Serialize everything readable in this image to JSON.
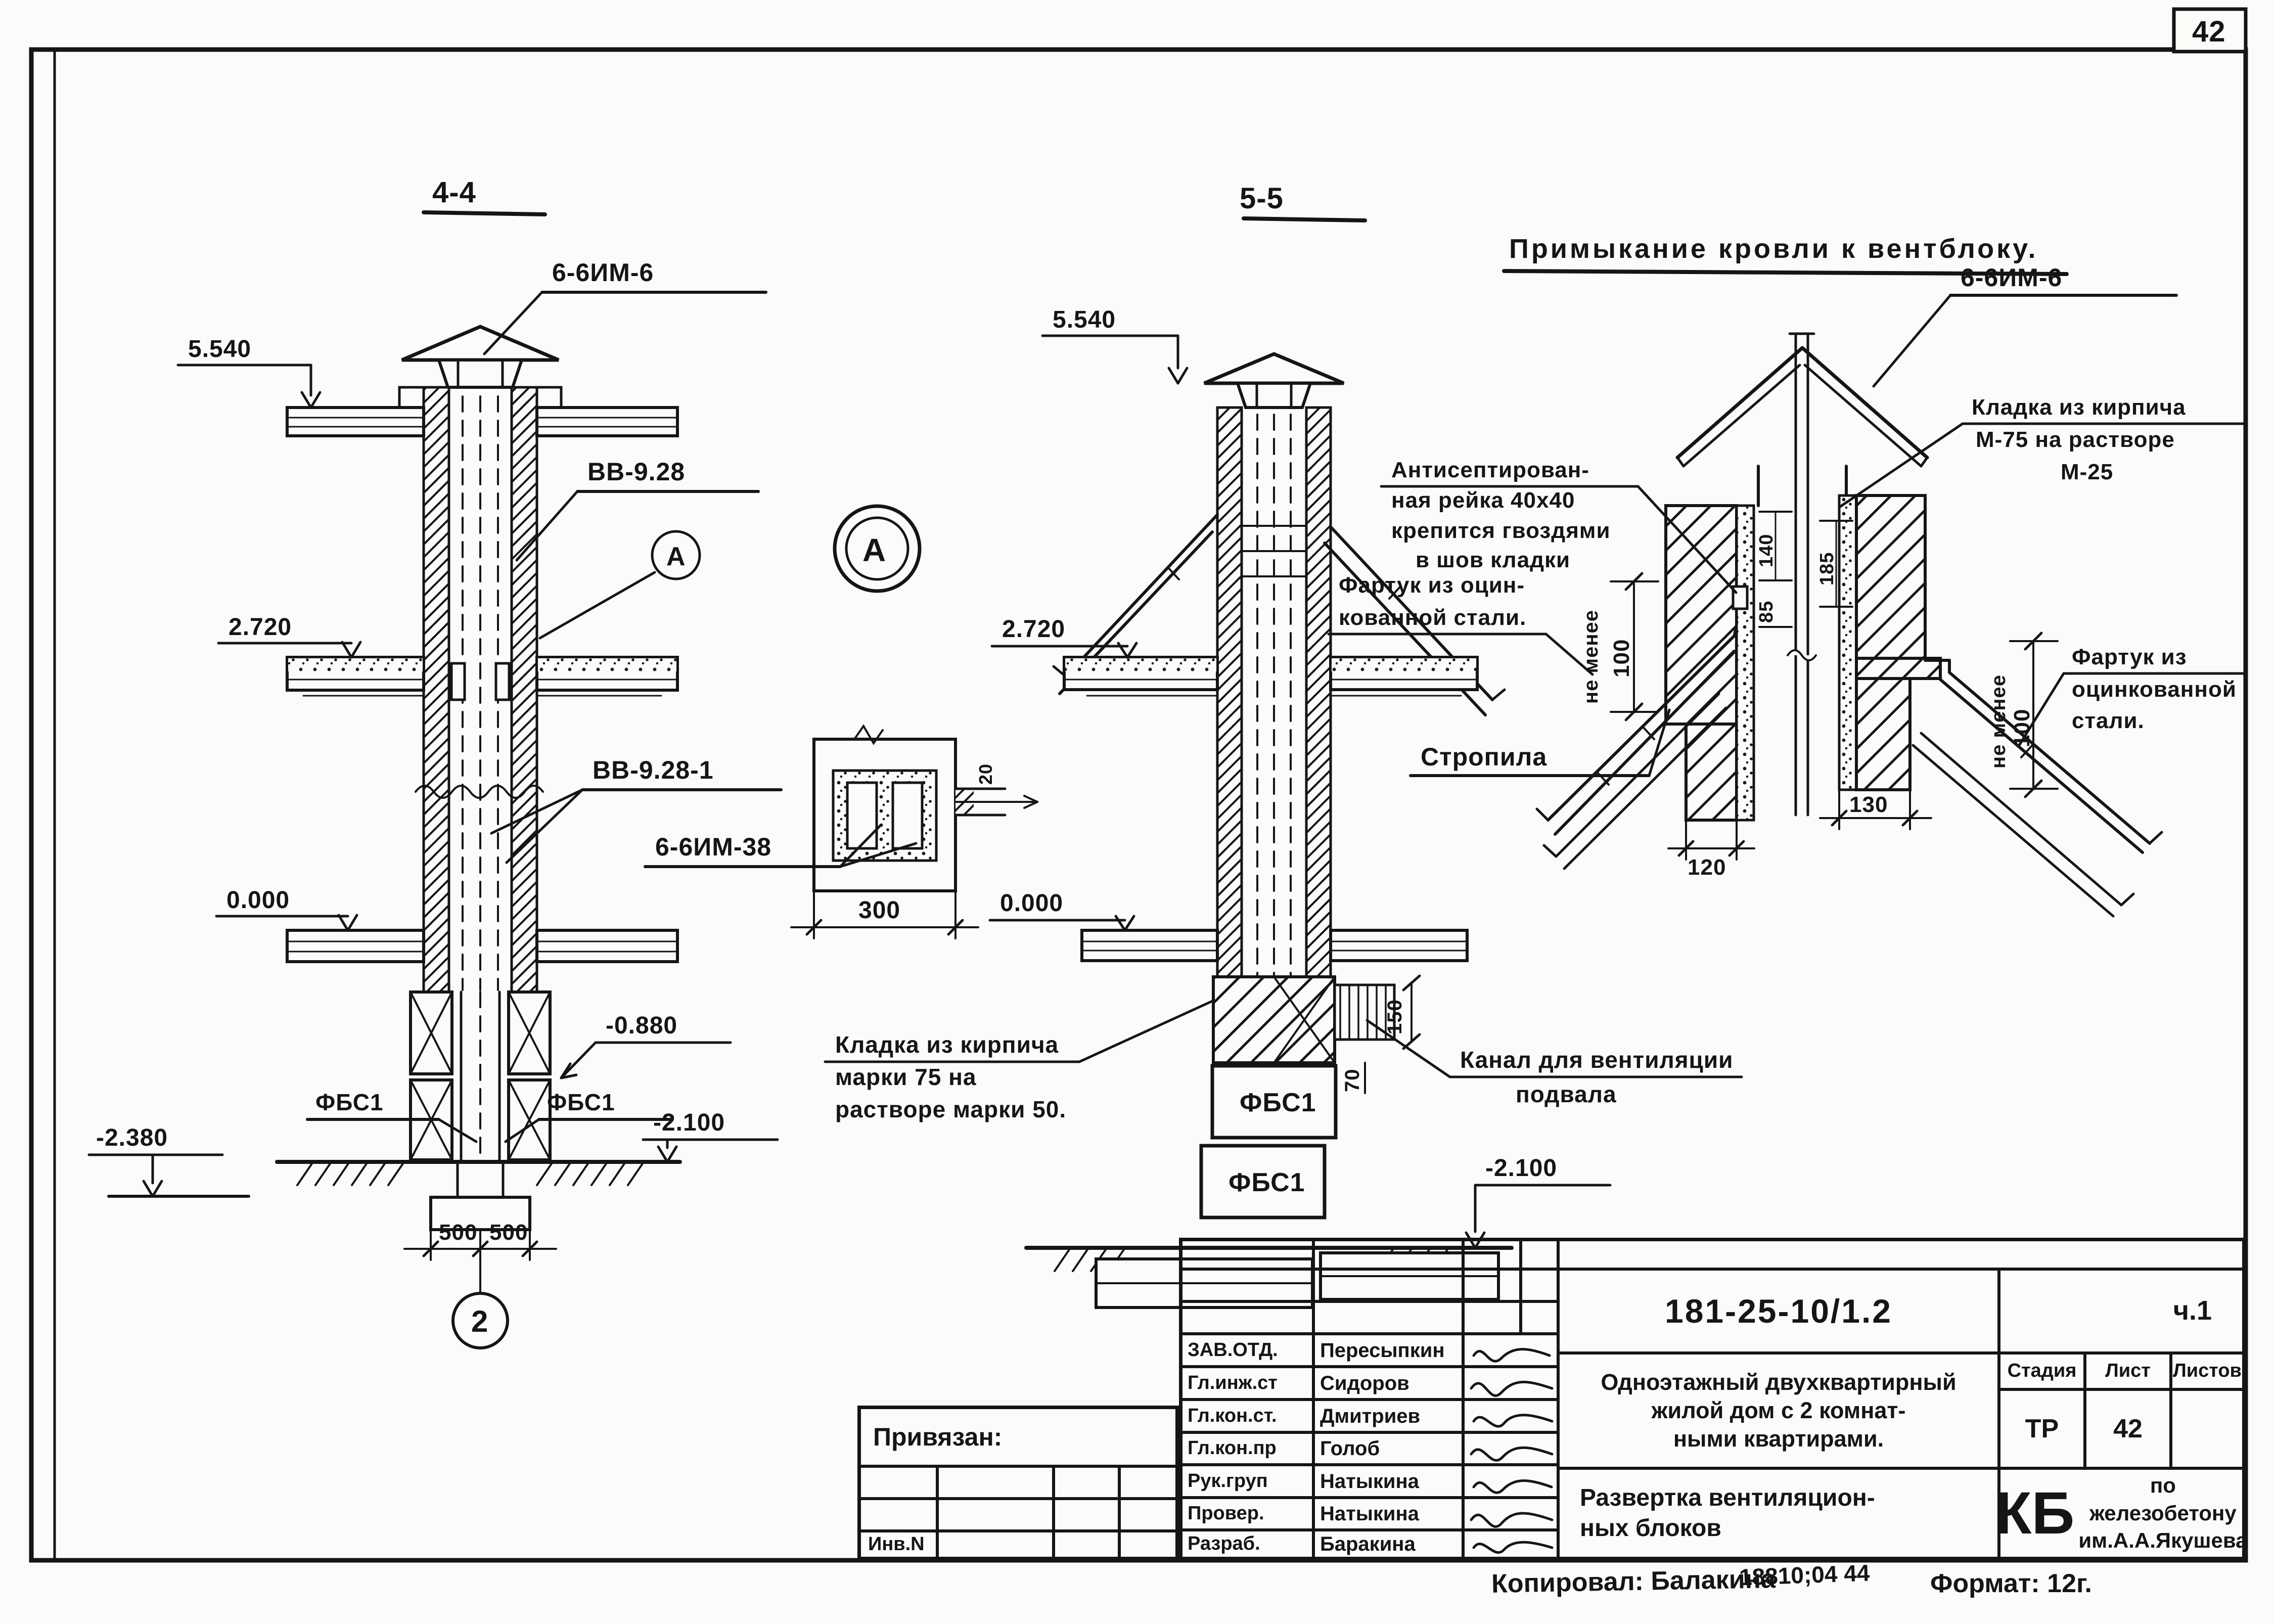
{
  "sheet": {
    "corner_number": "42",
    "copied_by": "Копировал: Балакина",
    "order_note": "18810;04 44",
    "format_note": "Формат: 12г."
  },
  "s44": {
    "title": "4-4",
    "cap_label": "6-6ИМ-6",
    "panel_label": "ВВ-9.28",
    "panel_label2": "ВВ-9.28-1",
    "view_marker": "А",
    "elev_top": "5.540",
    "elev_floor": "2.720",
    "elev_zero": "0.000",
    "elev_base": "-0.880",
    "elev_left": "-2.380",
    "elev_right": "-2.100",
    "fbs_left": "ФБС1",
    "fbs_right": "ФБС1",
    "dim_500_left": "500",
    "dim_500_right": "500",
    "axis_no": "2"
  },
  "detail_a": {
    "marker": "А",
    "label": "6-6ИМ-38",
    "dim_width": "300",
    "dim_duct": "20"
  },
  "s55": {
    "title": "5-5",
    "elev_top": "5.540",
    "elev_floor": "2.720",
    "elev_zero": "0.000",
    "elev_ground": "-2.100",
    "fbs_top": "ФБС1",
    "fbs_bottom": "ФБС1",
    "dim_150": "150",
    "dim_70": "70",
    "note_brick": [
      "Кладка из кирпича",
      "марки 75 на",
      "растворе марки 50."
    ],
    "note_canal": [
      "Канал для вентиляции",
      "подвала"
    ]
  },
  "roof_detail": {
    "title": "Примыкание кровли к вентблоку.",
    "cap_label": "6-6ИМ-6",
    "note_rail": [
      "Антисептирован-",
      "ная рейка 40х40",
      "крепится гвоздями",
      "в шов кладки"
    ],
    "note_apron_left": [
      "Фартук из оцин-",
      "кованной стали."
    ],
    "note_brick": [
      "Кладка из кирпича",
      "М-75 на растворе",
      "М-25"
    ],
    "note_apron_right": [
      "Фартук из",
      "оцинкованной",
      "стали."
    ],
    "note_rafter": "Стропила",
    "ne_menee_left": "не менее",
    "dim_100_left": "100",
    "ne_menee_right": "не менее",
    "dim_100_right": "100",
    "dim_140": "140",
    "dim_85": "85",
    "dim_185": "185",
    "dim_120": "120",
    "dim_130": "130"
  },
  "titleblock": {
    "doc_number": "181-25-10/1.2",
    "part": "ч.1",
    "project": [
      "Одноэтажный двухквартирный",
      "жилой дом с 2 комнат-",
      "ными квартирами."
    ],
    "stage_header": "Стадия",
    "sheet_header": "Лист",
    "sheets_header": "Листов",
    "stage": "ТР",
    "sheet_no": "42",
    "drawing_title": [
      "Развертка вентиляцион-",
      "ных блоков"
    ],
    "org_mark": "КБ",
    "org_line1": "по железобетону",
    "org_line2": "им.А.А.Якушева",
    "rows": [
      {
        "role": "ЗАВ.ОТД.",
        "name": "Пересыпкин"
      },
      {
        "role": "Гл.инж.ст",
        "name": "Сидоров"
      },
      {
        "role": "Гл.кон.ст.",
        "name": "Дмитриев"
      },
      {
        "role": "Гл.кон.пр",
        "name": "Голоб"
      },
      {
        "role": "Рук.груп",
        "name": "Натыкина"
      },
      {
        "role": "Провер.",
        "name": "Натыкина"
      },
      {
        "role": "Разраб.",
        "name": "Баракина"
      }
    ],
    "attached_label": "Привязан:",
    "inventory_label": "Инв.N"
  }
}
